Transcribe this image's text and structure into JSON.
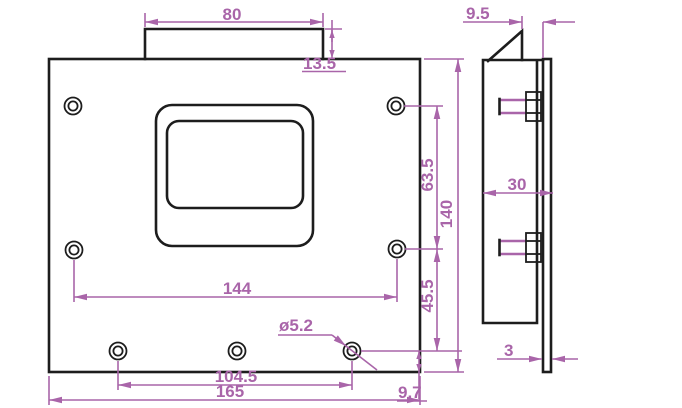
{
  "drawing": {
    "type": "engineering-cad-dimension-drawing",
    "views": [
      "front-view",
      "side-view"
    ],
    "colors": {
      "dimension_color": "#a965a9",
      "object_line_color": "#1d1d1d",
      "background": "#ffffff"
    },
    "front_view": {
      "features": {
        "plate": "rectangular plate with top tab",
        "opening": "central rounded rectangular opening",
        "holes": "7 round holes (2 top row, 2 middle row, 3 bottom row)"
      },
      "dims": {
        "tab_width": "80",
        "tab_height": "13.5",
        "upper_hole_span": "63.5",
        "overall_height": "140",
        "lower_hole_span": "45.5",
        "bottom_edge_offset": "9.7",
        "middle_hole_spacing": "144",
        "hole_diameter": "ø5.2",
        "bottom_hole_spacing": "104.5",
        "overall_width": "165"
      }
    },
    "side_view": {
      "features": {
        "body": "box section with bent top tab",
        "studs": "2 protruding threaded studs",
        "back_plate": "thin flat plate"
      },
      "dims": {
        "tab_tip_offset": "9.5",
        "overall_depth": "30",
        "back_plate_thickness": "3"
      }
    }
  }
}
